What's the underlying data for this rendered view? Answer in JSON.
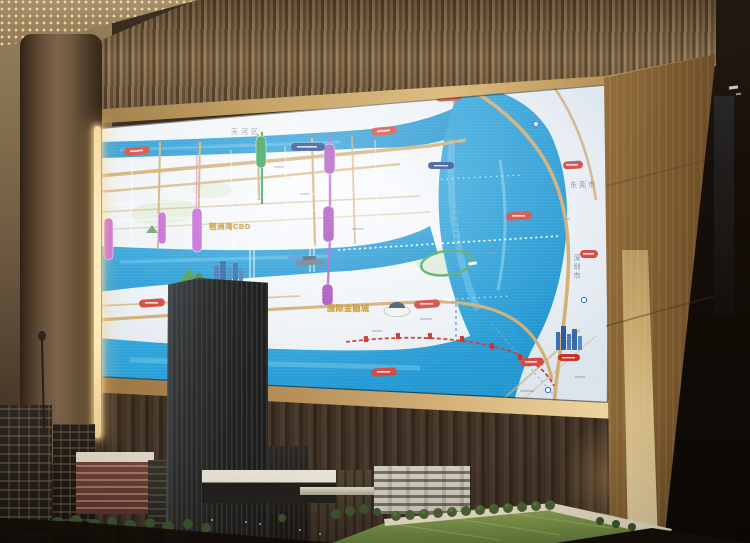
{
  "map": {
    "labels": {
      "district_tianhe": "天河区",
      "city_dongguan": "东莞市",
      "city_shenzhen": "深圳市",
      "zone_pazhou_bay": "琶洲湾CBD",
      "zone_financial_city": "国际金融城"
    },
    "colors": {
      "water": "#2aa2da",
      "road": "#d2ad74",
      "road_label_pill": "#d24840",
      "expressway_label_pill": "#1d3f92",
      "metro_purple": "#a84fbe",
      "metro_pink": "#c468d4",
      "metro_green": "#2f9e52",
      "metro_red": "#d23a30",
      "zone_label_gold": "#c8922c",
      "landmark_blue": "#2f64a4",
      "park_green": "#4e9a54"
    },
    "icons": {
      "cbd-towers-icon": "clustered high-rise blocks",
      "mountain-icon": "green peaks",
      "ship-icon": "naval ship silhouette",
      "dome-hall-icon": "white exhibition hall",
      "skyline-icon": "blue city skyline",
      "metro-roundel-icon": "blue/white circle"
    }
  },
  "environment": {
    "colors": {
      "slat_wall": "#8d7452",
      "gold_trim": "#d9b97e",
      "pillar_gold": "#d4ac6e",
      "led_cove_light": "#ffe9b8",
      "ribbed_wall": "#4a3a2b",
      "model_lawn": "#7d9447"
    }
  }
}
